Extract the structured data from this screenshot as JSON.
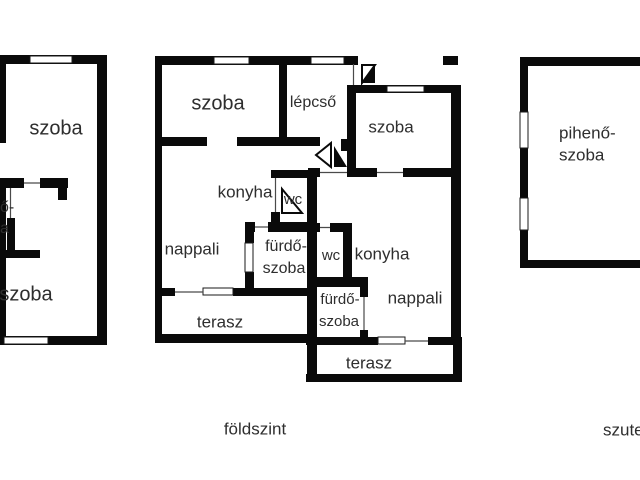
{
  "page": {
    "type": "floor-plan-drawing",
    "background": "#ffffff"
  },
  "colors": {
    "wall": "#0a0a0a",
    "text": "#2e2e2e",
    "thin_line": "#4a4a4a",
    "background": "#ffffff"
  },
  "plan_left": {
    "rooms": {
      "szoba_top": "szoba",
      "fragment_line1": "ő-",
      "fragment_line2": "a",
      "szoba_bottom": "szoba"
    }
  },
  "plan_ground": {
    "caption": "földszint",
    "rooms": {
      "szoba_tl": "szoba",
      "lepcso": "lépcső",
      "szoba_tr": "szoba",
      "konyha_left": "konyha",
      "wc_left": "wc",
      "nappali_left": "nappali",
      "furdo_left_line1": "fürdő-",
      "furdo_left_line2": "szoba",
      "wc_right": "wc",
      "konyha_right": "konyha",
      "furdo_right_line1": "fürdő-",
      "furdo_right_line2": "szoba",
      "nappali_right": "nappali",
      "terasz_left": "terasz",
      "terasz_right": "terasz"
    }
  },
  "plan_basement": {
    "caption": "szuterén",
    "rooms": {
      "piheno_line1": "pihenő-",
      "piheno_line2": "szoba"
    }
  }
}
